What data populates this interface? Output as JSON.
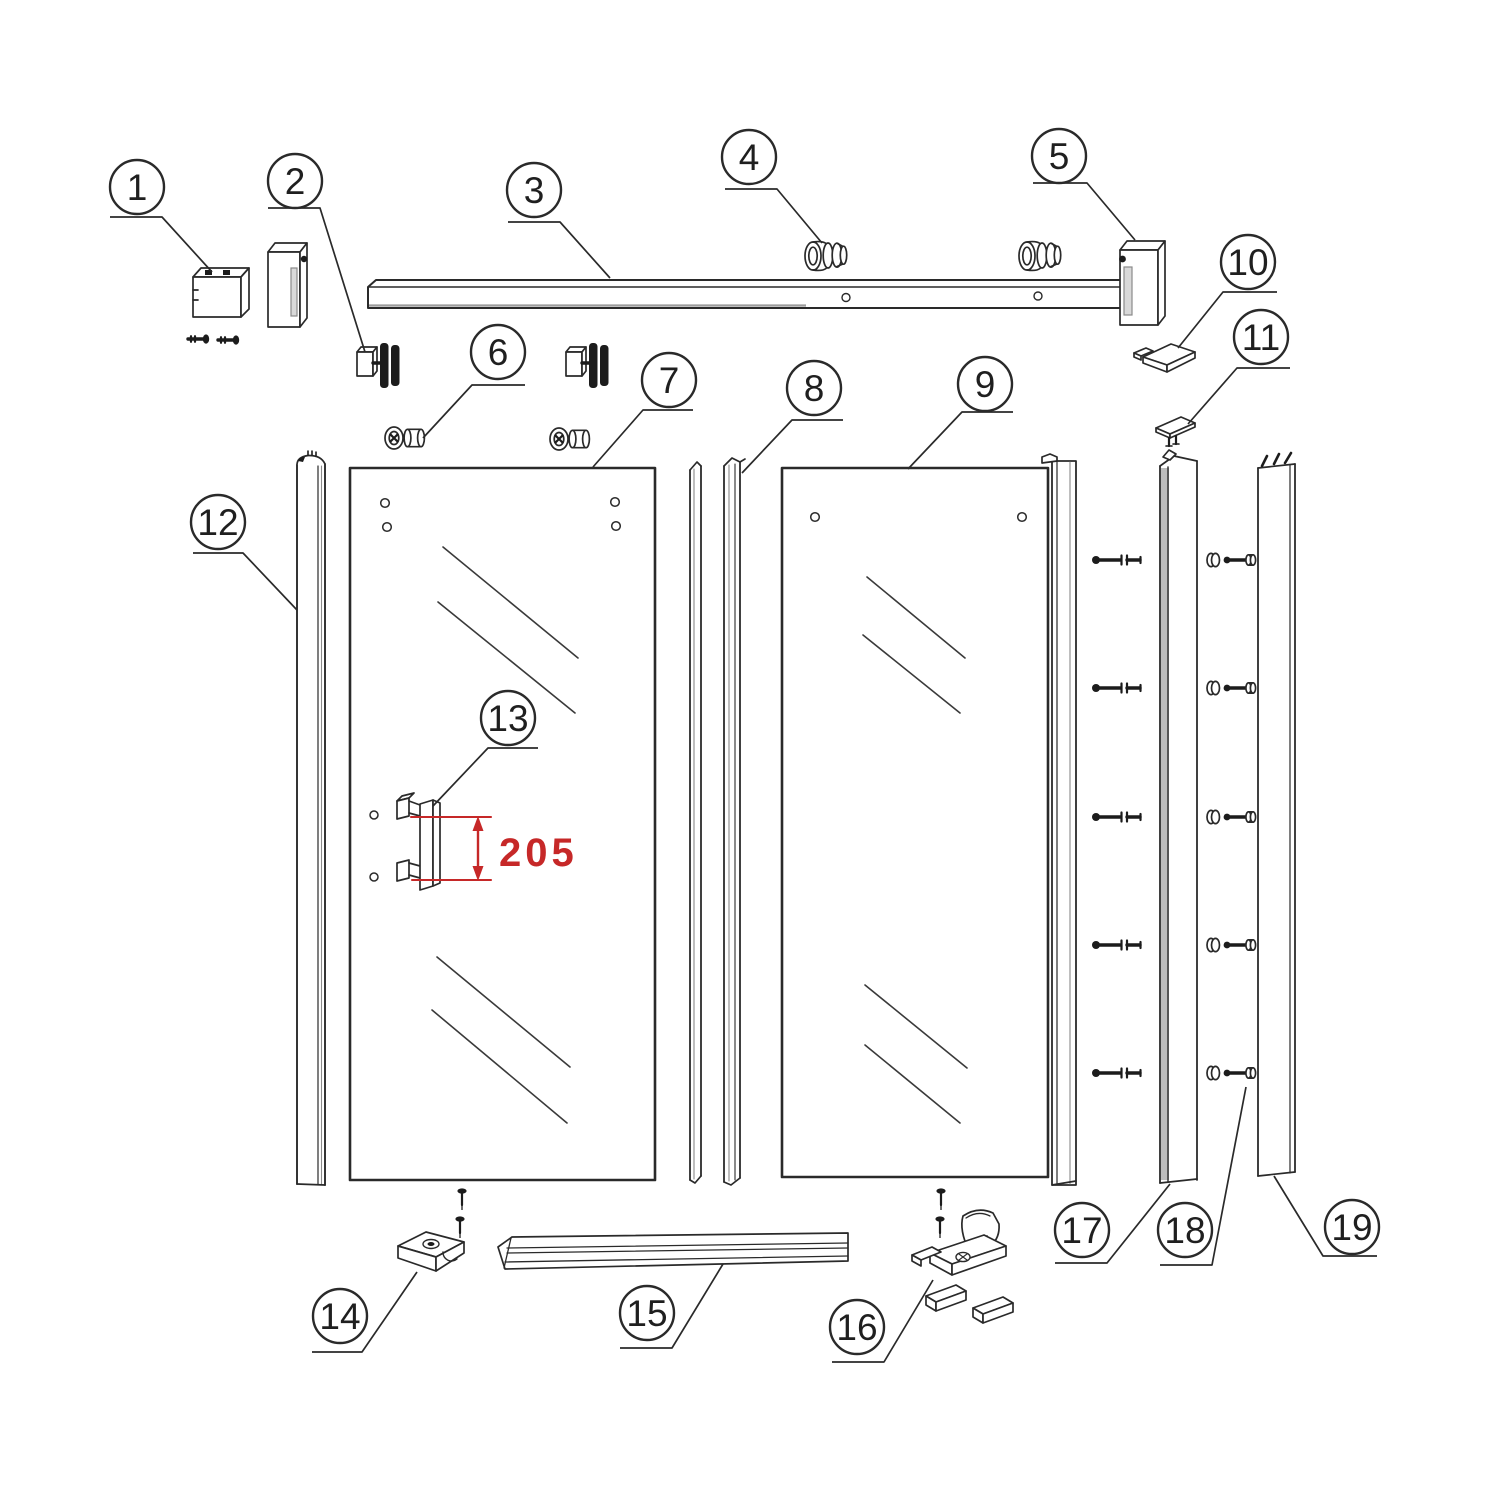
{
  "colors": {
    "line": "#2a2a2a",
    "dimension": "#c62828",
    "shade": "#bdbdbd",
    "background": "#ffffff"
  },
  "dimension": {
    "value": "205"
  },
  "callouts": [
    {
      "label": "1"
    },
    {
      "label": "2"
    },
    {
      "label": "3"
    },
    {
      "label": "4"
    },
    {
      "label": "5"
    },
    {
      "label": "6"
    },
    {
      "label": "7"
    },
    {
      "label": "8"
    },
    {
      "label": "9"
    },
    {
      "label": "10"
    },
    {
      "label": "11"
    },
    {
      "label": "12"
    },
    {
      "label": "13"
    },
    {
      "label": "14"
    },
    {
      "label": "15"
    },
    {
      "label": "16"
    },
    {
      "label": "17"
    },
    {
      "label": "18"
    },
    {
      "label": "19"
    }
  ]
}
